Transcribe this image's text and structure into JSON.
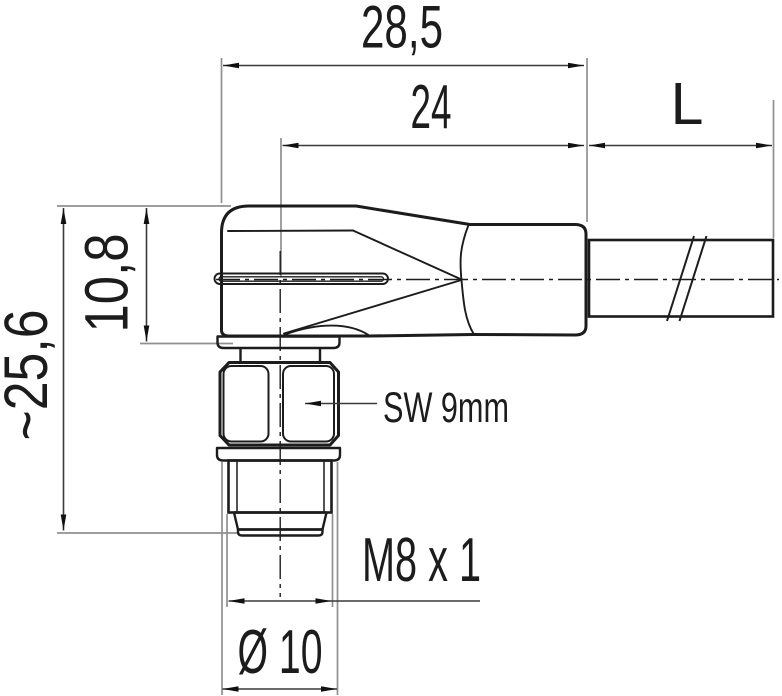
{
  "drawing": {
    "type": "technical-dimension-drawing",
    "subject": "M8 male angled cable connector, side view",
    "background_color": "#ffffff",
    "outline_color": "#1c1c1c",
    "extension_line_color": "#8f8f8f",
    "dimension_line_color": "#3a3a3a",
    "labels": {
      "width_total": "28,5",
      "width_body": "24",
      "cable_length": "L",
      "height_body": "10,8",
      "height_total": "~25,6",
      "wrench_size": "SW 9mm",
      "thread_spec": "M8 x 1",
      "flange_diameter": "Ø 10"
    }
  }
}
